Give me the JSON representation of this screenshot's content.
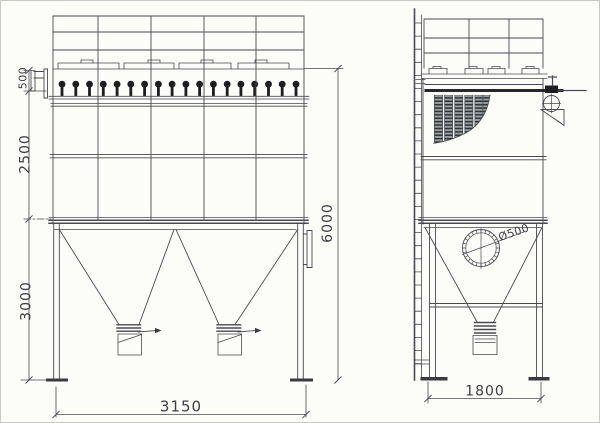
{
  "colors": {
    "paper": "#fcfcf9",
    "line": "#4a4a52",
    "dark_fill": "#1d1d22",
    "dim_text": "#3e3e46"
  },
  "views": {
    "front": {
      "valve_count": 18,
      "dims": {
        "valve_section": "500",
        "body_height": "2500",
        "leg_height": "3000",
        "overall_height": "6000",
        "overall_width": "3150"
      }
    },
    "side": {
      "dims": {
        "overall_width": "1800",
        "inlet_diameter": "Ø500"
      }
    }
  }
}
